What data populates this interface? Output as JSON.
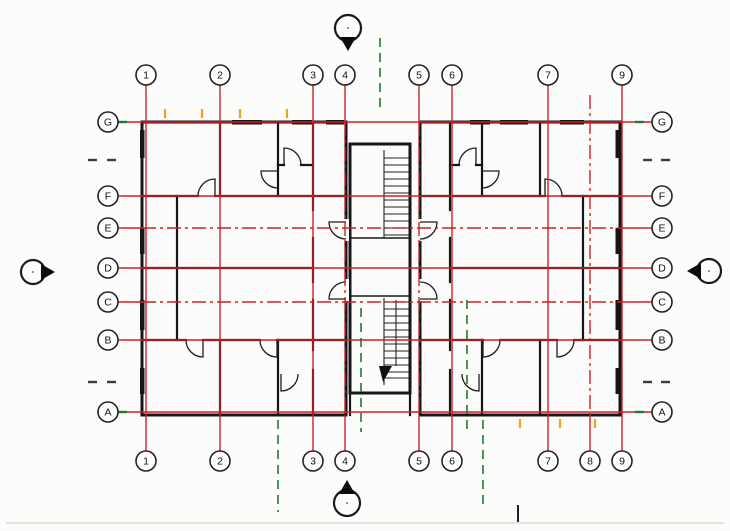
{
  "drawing": {
    "title": "Residential building floor plan (two mirrored apartment wings with central stair core)",
    "colors": {
      "background": "#fcfcfb",
      "grid_red": "#d01f26",
      "centerline_green": "#1e7a34",
      "tick_orange": "#f59f1d",
      "wall_black": "#161616"
    },
    "grid": {
      "bubble_radius": 10,
      "top_bubble_cy": 75,
      "bottom_bubble_cy": 461,
      "left_bubble_cx": 108,
      "right_bubble_cx": 662,
      "line_top_y": 85,
      "line_top_y_nobubble": 95,
      "line_bottom_y": 451,
      "line_left_x": 118,
      "line_right_x": 652,
      "plan_top_y": 122,
      "plan_bottom_y": 415,
      "plan_left_x": 142,
      "plan_right_x": 620,
      "columns": [
        {
          "label": "1",
          "x": 146,
          "style": "solid",
          "top_bubble": true,
          "bottom_bubble": true
        },
        {
          "label": "2",
          "x": 220,
          "style": "solid",
          "top_bubble": true,
          "bottom_bubble": true
        },
        {
          "label": "3",
          "x": 313,
          "style": "solid",
          "top_bubble": true,
          "bottom_bubble": true
        },
        {
          "label": "4",
          "x": 345,
          "style": "dashdot-mid",
          "top_bubble": true,
          "bottom_bubble": true
        },
        {
          "label": "5",
          "x": 419,
          "style": "dashdot-mid",
          "top_bubble": true,
          "bottom_bubble": true
        },
        {
          "label": "6",
          "x": 452,
          "style": "solid",
          "top_bubble": true,
          "bottom_bubble": true
        },
        {
          "label": "7",
          "x": 548,
          "style": "solid",
          "top_bubble": true,
          "bottom_bubble": true
        },
        {
          "label": "8",
          "x": 590,
          "style": "dashdot",
          "top_bubble": false,
          "bottom_bubble": true
        },
        {
          "label": "9",
          "x": 622,
          "style": "solid",
          "top_bubble": true,
          "bottom_bubble": true
        }
      ],
      "rows": [
        {
          "label": "G",
          "y": 122,
          "style": "solid"
        },
        {
          "label": "F",
          "y": 196,
          "style": "solid"
        },
        {
          "label": "E",
          "y": 228,
          "style": "dashdot"
        },
        {
          "label": "D",
          "y": 268,
          "style": "solid"
        },
        {
          "label": "C",
          "y": 302,
          "style": "dashdot"
        },
        {
          "label": "B",
          "y": 340,
          "style": "solid"
        },
        {
          "label": "A",
          "y": 412,
          "style": "solid"
        }
      ]
    },
    "section_markers": [
      {
        "name": "section-marker-top",
        "cx": 348,
        "cy": 28,
        "r": 13,
        "direction": "down"
      },
      {
        "name": "section-marker-bottom",
        "cx": 347,
        "cy": 503,
        "r": 13,
        "direction": "up"
      },
      {
        "name": "section-marker-left",
        "cx": 33,
        "cy": 272,
        "r": 12,
        "direction": "right"
      },
      {
        "name": "section-marker-right",
        "cx": 709,
        "cy": 271,
        "r": 12,
        "direction": "left"
      }
    ],
    "green_centerlines": [
      {
        "x": 380,
        "y1": 38,
        "y2": 112
      },
      {
        "x": 361,
        "y1": 308,
        "y2": 432
      },
      {
        "x": 467,
        "y1": 300,
        "y2": 432
      },
      {
        "x": 278,
        "y1": 420,
        "y2": 512
      },
      {
        "x": 483,
        "y1": 420,
        "y2": 506
      }
    ],
    "green_ticks": [
      {
        "x1": 118,
        "y1": 122,
        "x2": 127,
        "y2": 122
      },
      {
        "x1": 635,
        "y1": 122,
        "x2": 644,
        "y2": 122
      },
      {
        "x1": 118,
        "y1": 412,
        "x2": 127,
        "y2": 412
      },
      {
        "x1": 635,
        "y1": 412,
        "x2": 644,
        "y2": 412
      }
    ],
    "orange_ticks": [
      {
        "x": 165,
        "y1": 109,
        "y2": 118
      },
      {
        "x": 202,
        "y1": 109,
        "y2": 118
      },
      {
        "x": 240,
        "y1": 109,
        "y2": 118
      },
      {
        "x": 287,
        "y1": 109,
        "y2": 118
      },
      {
        "x": 520,
        "y1": 419,
        "y2": 428
      },
      {
        "x": 560,
        "y1": 419,
        "y2": 428
      },
      {
        "x": 595,
        "y1": 419,
        "y2": 428
      }
    ],
    "black_dash_marks": [
      {
        "x1": 88,
        "y1": 160,
        "x2": 97,
        "y2": 160
      },
      {
        "x1": 107,
        "y1": 160,
        "x2": 116,
        "y2": 160
      },
      {
        "x1": 88,
        "y1": 382,
        "x2": 97,
        "y2": 382
      },
      {
        "x1": 107,
        "y1": 382,
        "x2": 116,
        "y2": 382
      },
      {
        "x1": 643,
        "y1": 160,
        "x2": 652,
        "y2": 160
      },
      {
        "x1": 661,
        "y1": 160,
        "x2": 670,
        "y2": 160
      },
      {
        "x1": 643,
        "y1": 382,
        "x2": 652,
        "y2": 382
      },
      {
        "x1": 661,
        "y1": 382,
        "x2": 670,
        "y2": 382
      }
    ],
    "misc": {
      "bottom_tick": {
        "x": 518,
        "y1": 505,
        "y2": 522
      },
      "page_edge_line": {
        "x1": 6,
        "y1": 523,
        "x2": 724,
        "y2": 523
      }
    }
  }
}
